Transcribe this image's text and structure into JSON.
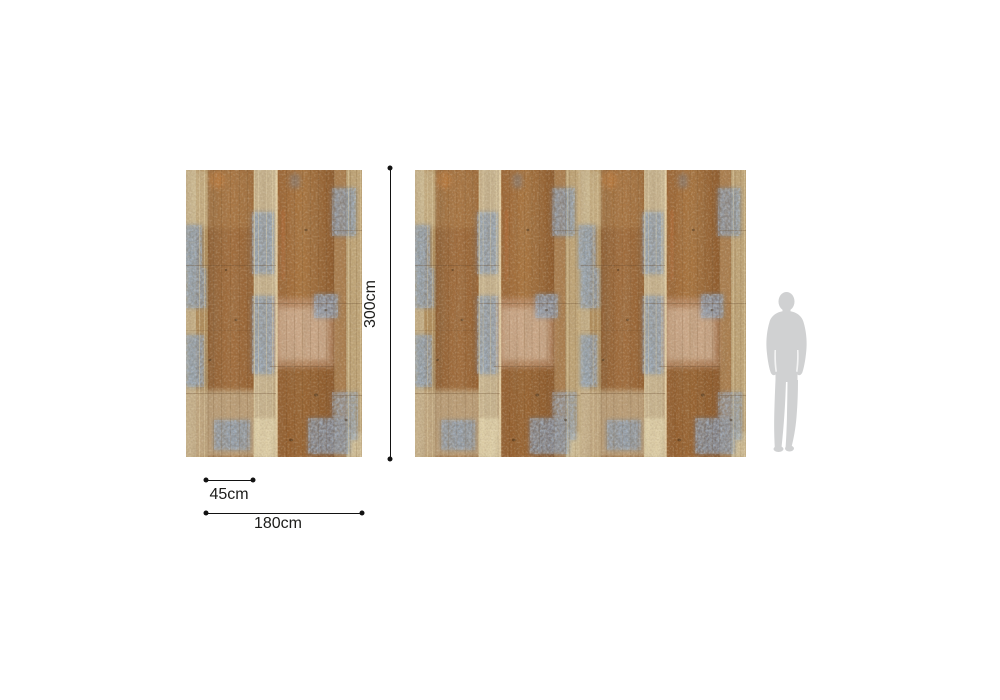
{
  "diagram": {
    "title": "wallpaper panel scale diagram",
    "dimensions": {
      "height": {
        "label": "300cm"
      },
      "strip_width": {
        "label": "45cm"
      },
      "panel_width": {
        "label": "180cm"
      }
    },
    "panels": {
      "single_panel_repeats": 1,
      "wide_panel_repeats": 2
    },
    "icons": {
      "human_figure": "human-scale-silhouette"
    },
    "colors": {
      "background": "#ffffff",
      "dimension_line": "#121212",
      "label_text": "#1d1d1b",
      "silhouette": "#d0d1d2",
      "wood_brown": "#a06c3c",
      "wood_brown_dark": "#8a5526",
      "wood_tan": "#c7b28a",
      "wood_cream": "#ecdcb2",
      "wood_blue_patch": "#6e87a6",
      "wood_pink_patch": "#c79e83"
    }
  }
}
